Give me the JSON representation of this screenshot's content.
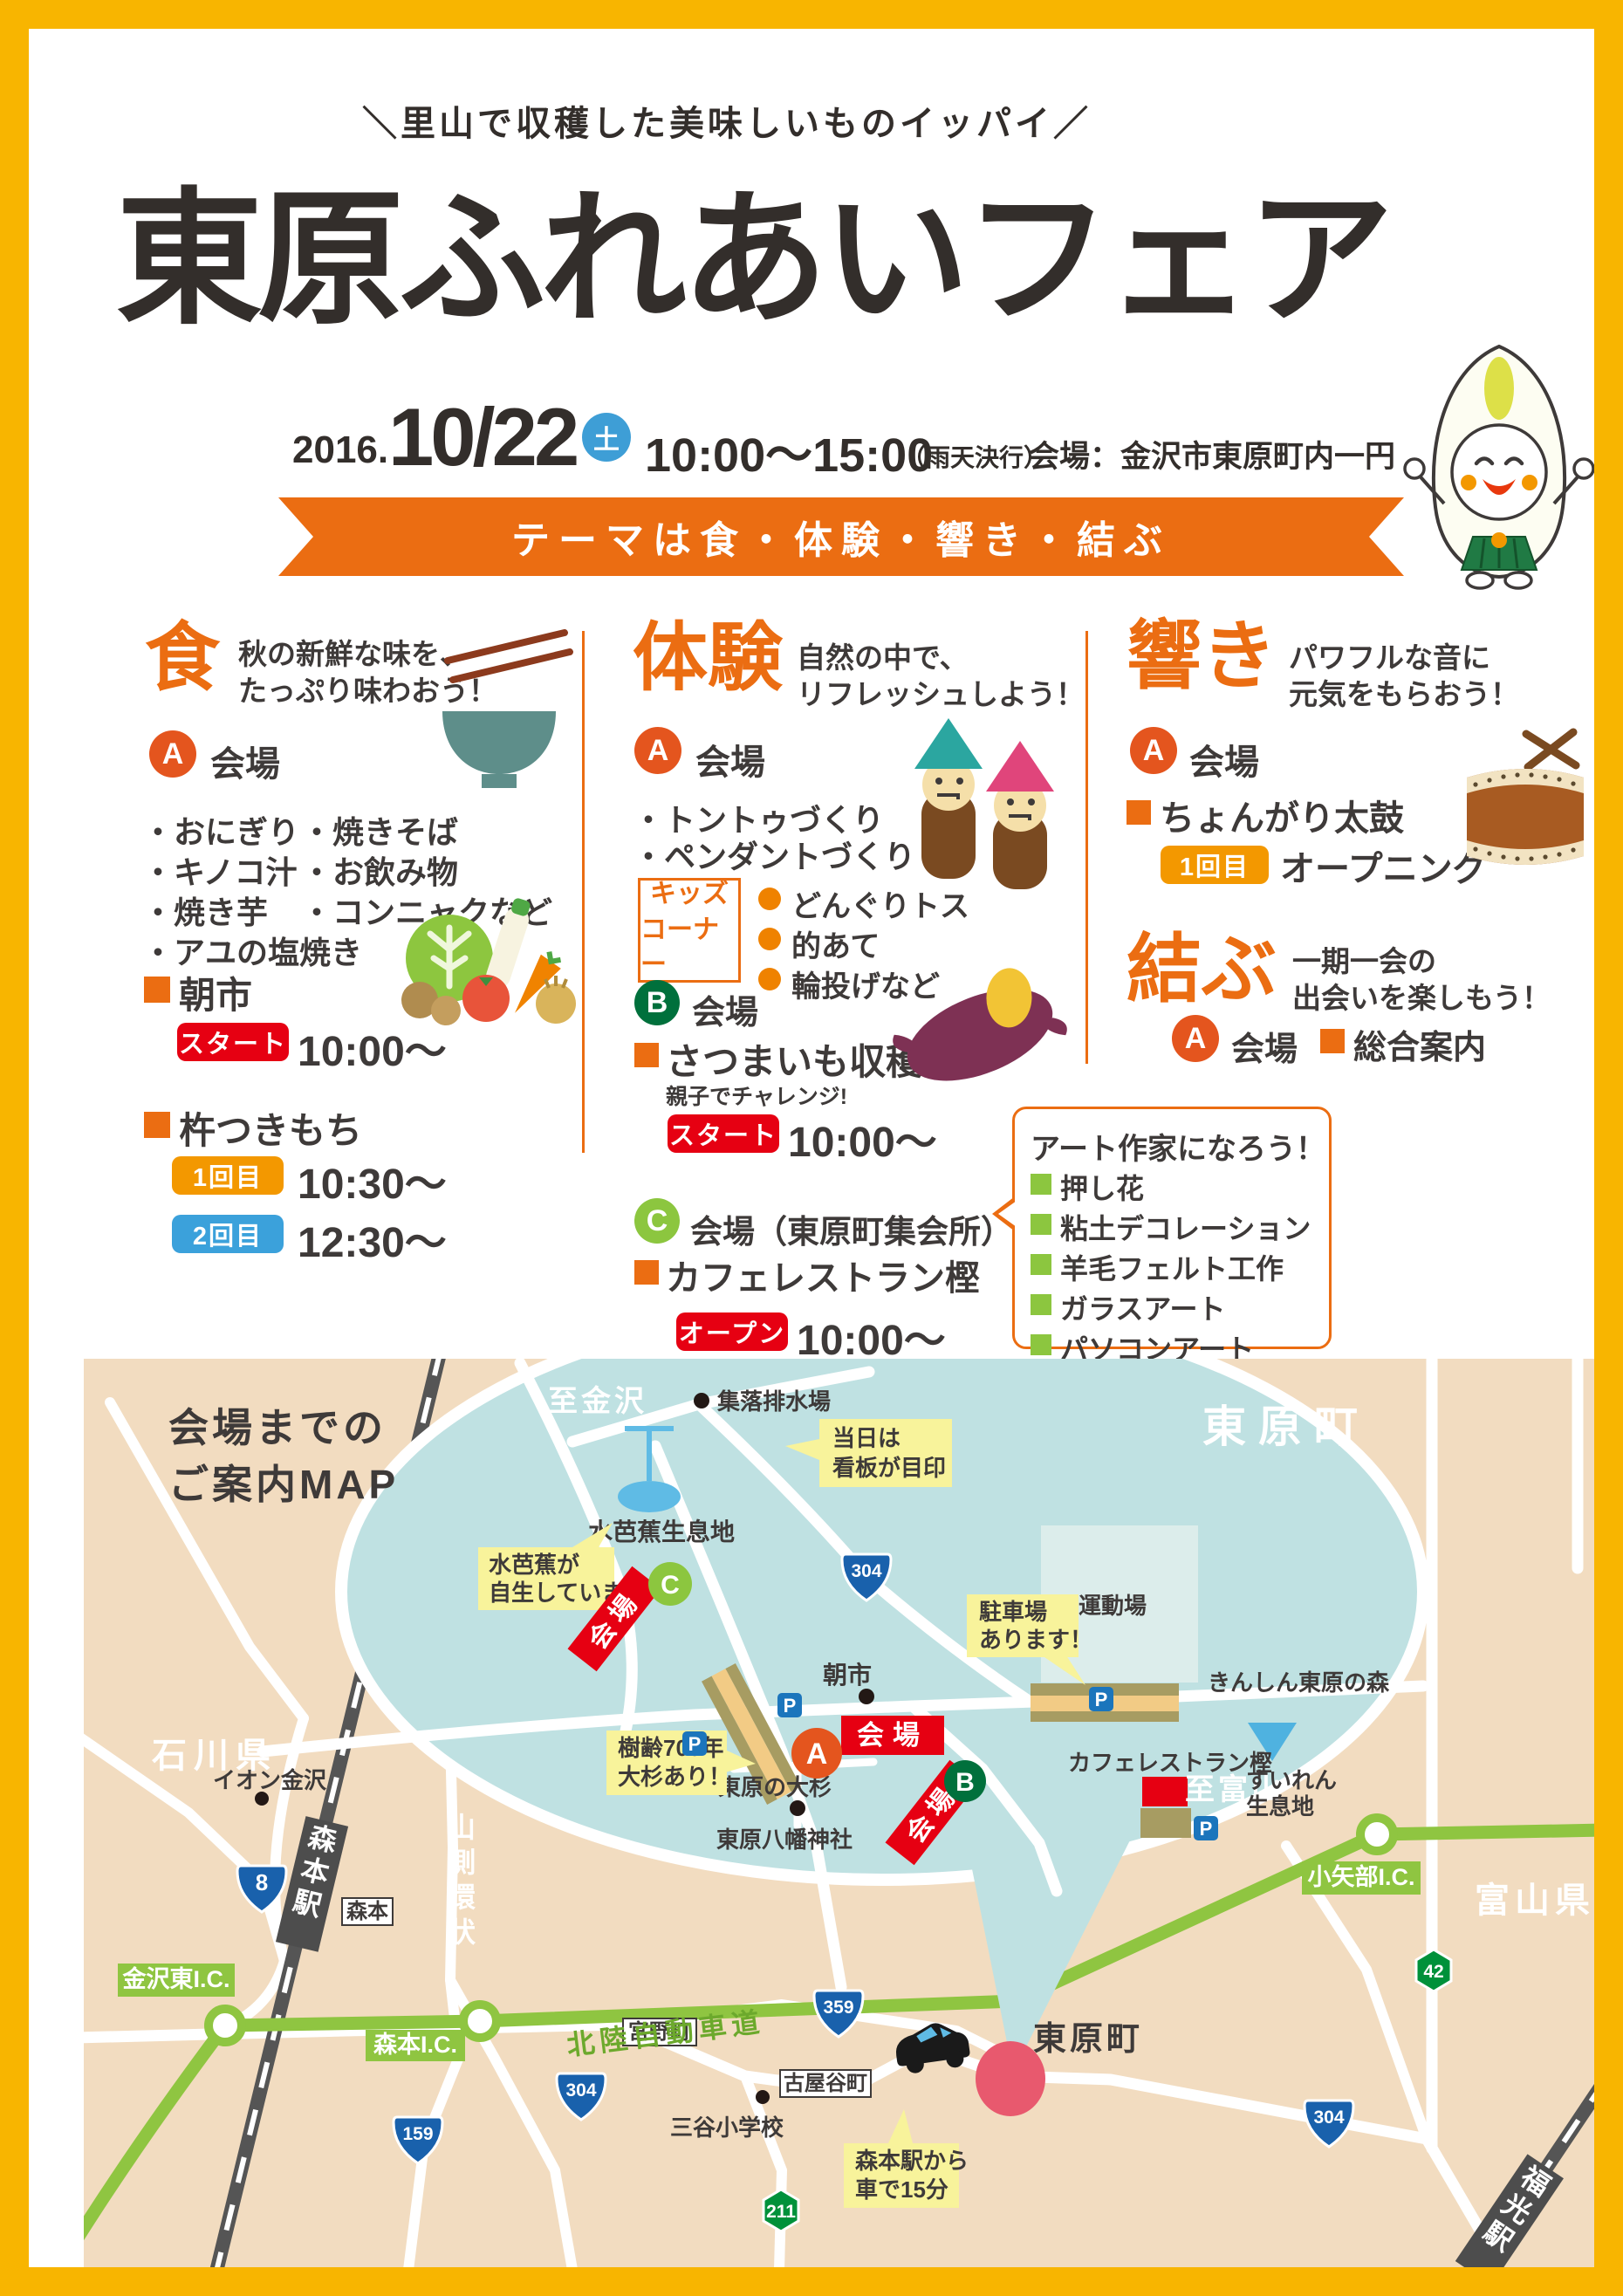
{
  "header": {
    "tagline": "＼里山で収穫した美味しいものイッパイ／",
    "title": "東原ふれあいフェア",
    "year": "2016.",
    "day": "10/22",
    "weekday": "土",
    "time": "10:00〜15:00",
    "rain_note": "（雨天決行）",
    "venue": "会場：金沢市東原町内一円",
    "theme": "テーマは食・体験・響き・結ぶ"
  },
  "shoku": {
    "title": "食",
    "subtitle1": "秋の新鮮な味を、",
    "subtitle2": "たっぷり味わおう！",
    "badge_a": "A",
    "venue_label": "会場",
    "menu_left": [
      "・おにぎり",
      "・キノコ汁",
      "・焼き芋",
      "・アユの塩焼き"
    ],
    "menu_right": [
      "・焼きそば",
      "・お飲み物",
      "・コンニャクなど"
    ],
    "asaichi_label": "朝市",
    "asaichi_badge": "スタート",
    "asaichi_time": "10:00〜",
    "mochi_label": "杵つきもち",
    "mochi_r1_badge": "1回目",
    "mochi_r1_time": "10:30〜",
    "mochi_r2_badge": "2回目",
    "mochi_r2_time": "12:30〜"
  },
  "taiken": {
    "title": "体験",
    "subtitle1": "自然の中で、",
    "subtitle2": "リフレッシュしよう！",
    "badge_a": "A",
    "venue_a": "会場",
    "items": [
      "・トントゥづくり",
      "・ペンダントづくり"
    ],
    "kids_line1": "キッズ",
    "kids_line2": "コーナー",
    "kids_items": [
      "どんぐりトス",
      "的あて",
      "輪投げなど"
    ],
    "badge_b": "B",
    "venue_b": "会場",
    "imo_label": "さつまいも収穫",
    "imo_note": "親子でチャレンジ!",
    "imo_badge": "スタート",
    "imo_time": "10:00〜",
    "badge_c": "C",
    "venue_c": "会場（東原町集会所）",
    "cafe_label": "カフェレストラン樫",
    "cafe_badge": "オープン",
    "cafe_time": "10:00〜"
  },
  "hibiki": {
    "title": "響き",
    "subtitle1": "パワフルな音に",
    "subtitle2": "元気をもらおう！",
    "badge_a": "A",
    "venue_a": "会場",
    "taiko_label": "ちょんがり太鼓",
    "round_badge": "1回目",
    "round_label": "オープニング"
  },
  "musubu": {
    "title": "結ぶ",
    "subtitle1": "一期一会の",
    "subtitle2": "出会いを楽しもう！",
    "badge_a": "A",
    "venue_a": "会場",
    "info_label": "総合案内"
  },
  "art": {
    "title": "アート作家になろう！",
    "items": [
      "押し花",
      "粘土デコレーション",
      "羊毛フェルト工作",
      "ガラスアート",
      "パソコンアート"
    ]
  },
  "map": {
    "title1": "会場までの",
    "title2": "ご案内MAP",
    "ishikawa": "石川県",
    "toyama": "富山県",
    "to_kanazawa": "至金沢",
    "to_toyama": "至富山",
    "higashihara_big": "東原町",
    "higashihara_small": "東原町",
    "drainage": "集落排水場",
    "mizubasho_habitat": "水芭蕉生息地",
    "asaichi": "朝市",
    "undojo": "運動場",
    "kinshin": "きんしん東原の森",
    "cafe": "カフェレストラン樫",
    "suiren1": "すいれん",
    "suiren2": "生息地",
    "osugi": "東原の大杉",
    "jinja": "東原八幡神社",
    "aeon": "イオン金沢",
    "mitani": "三谷小学校",
    "morimoto_box": "森本",
    "miyano": "宮野町",
    "furuyadani": "古屋谷町",
    "morimoto_sta": "森本駅",
    "fukumitsu_sta": "福光駅",
    "hokuriku_exp": "北陸自動車道",
    "yamagawa": "山側環状",
    "ic_kanazawa": "金沢東I.C.",
    "ic_morimoto": "森本I.C.",
    "ic_oyabe": "小矢部I.C.",
    "callout_signboard1": "当日は",
    "callout_signboard2": "看板が目印",
    "callout_mizubasho1": "水芭蕉が",
    "callout_mizubasho2": "自生しています",
    "callout_parking1": "駐車場",
    "callout_parking2": "あります！",
    "callout_osugi1": "樹齢700年",
    "callout_osugi2": "大杉あり！",
    "callout_station1": "森本駅から",
    "callout_station2": "車で15分",
    "venue_a": "会場",
    "venue_b": "会場",
    "venue_c": "会場",
    "badge_a": "A",
    "badge_b": "B",
    "badge_c": "C",
    "p": "P",
    "r304": "304",
    "r8": "8",
    "r359": "359",
    "r159": "159",
    "r42": "42",
    "r211": "211"
  },
  "colors": {
    "accent_orange": "#EB6D12",
    "badge_red": "#E60012",
    "badge_blue": "#3BA1DB",
    "badge_amber": "#F39800",
    "border_yellow": "#F8B500",
    "map_green": "#8FC541",
    "map_blue": "#BFE1E2",
    "map_beige": "#F2DCC0"
  }
}
